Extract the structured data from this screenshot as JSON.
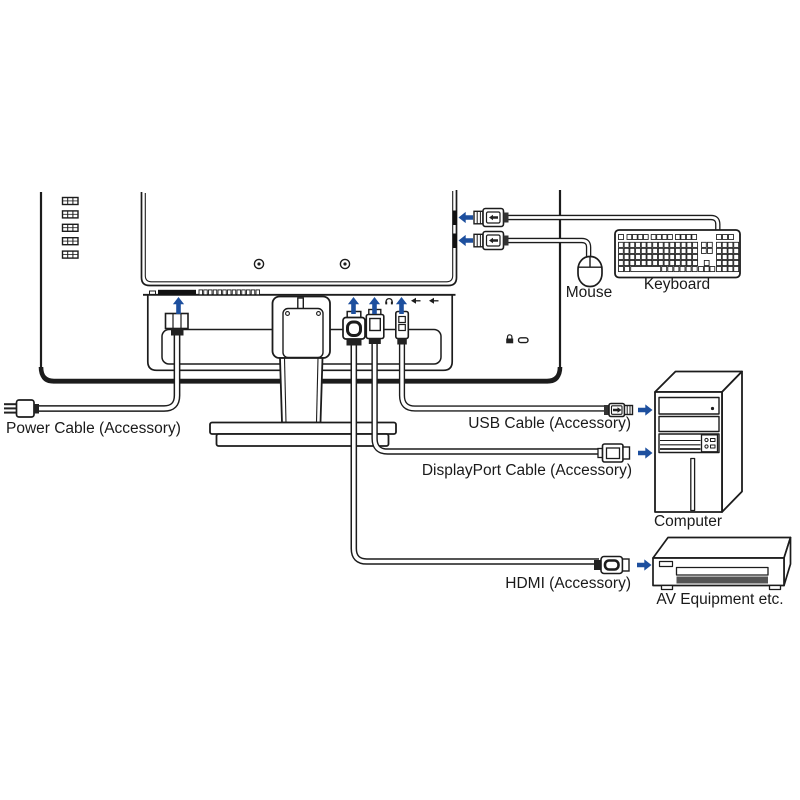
{
  "diagram": {
    "labels": {
      "power_cable": "Power Cable (Accessory)",
      "usb_cable": "USB Cable (Accessory)",
      "displayport_cable": "DisplayPort Cable (Accessory)",
      "hdmi": "HDMI (Accessory)",
      "mouse": "Mouse",
      "keyboard": "Keyboard",
      "computer": "Computer",
      "av_equipment": "AV Equipment etc."
    },
    "colors": {
      "line": "#1c1c1c",
      "arrow_blue": "#1d4f9e",
      "connector_dark": "#222222",
      "tray_dark": "#545454"
    },
    "icons": [
      "up-arrow-icon",
      "left-arrow-icon",
      "right-arrow-icon",
      "headphone-jack-icon",
      "usb-downstream-port-icon",
      "kensington-lock-icon",
      "security-slot-icon",
      "vesa-screw-hole",
      "vent-slot",
      "keyboard-key"
    ]
  }
}
